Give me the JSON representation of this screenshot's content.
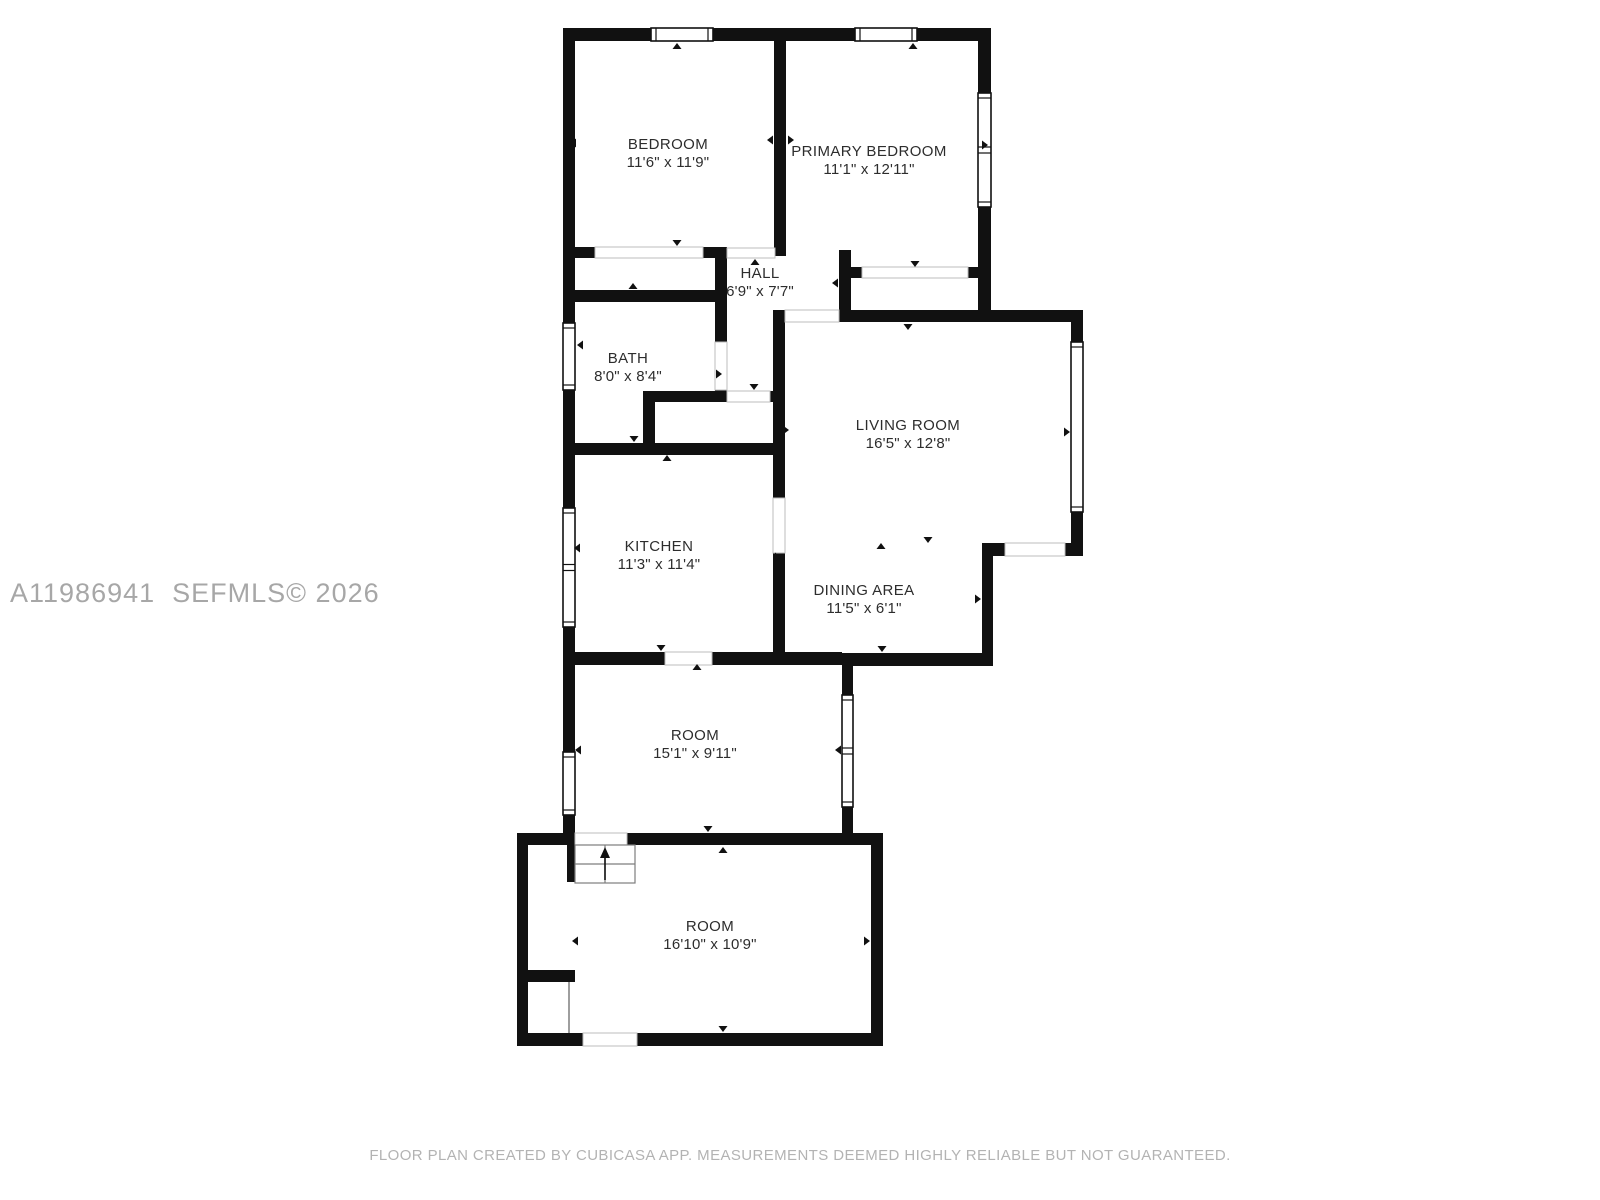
{
  "watermark": "A11986941  SEFMLS© 2026",
  "footer": "FLOOR PLAN CREATED BY CUBICASA APP. MEASUREMENTS DEEMED HIGHLY RELIABLE BUT NOT GUARANTEED.",
  "colors": {
    "wall": "#111111",
    "label": "#2d2d2d",
    "watermark": "#a7a7a7",
    "footer": "#b3b3b3",
    "door_line": "#bdbdbd",
    "stairs_line": "#7d7d7d",
    "floor": "#ffffff"
  },
  "rooms": [
    {
      "id": "bedroom",
      "name": "BEDROOM",
      "dims": "11'6\" x 11'9\"",
      "cx": 668,
      "cy": 144
    },
    {
      "id": "primary-bedroom",
      "name": "PRIMARY BEDROOM",
      "dims": "11'1\" x 12'11\"",
      "cx": 869,
      "cy": 151
    },
    {
      "id": "hall",
      "name": "HALL",
      "dims": "6'9\" x 7'7\"",
      "cx": 760,
      "cy": 273
    },
    {
      "id": "bath",
      "name": "BATH",
      "dims": "8'0\" x 8'4\"",
      "cx": 628,
      "cy": 358
    },
    {
      "id": "living-room",
      "name": "LIVING ROOM",
      "dims": "16'5\" x 12'8\"",
      "cx": 908,
      "cy": 425
    },
    {
      "id": "kitchen",
      "name": "KITCHEN",
      "dims": "11'3\" x 11'4\"",
      "cx": 659,
      "cy": 546
    },
    {
      "id": "dining-area",
      "name": "DINING AREA",
      "dims": "11'5\" x 6'1\"",
      "cx": 864,
      "cy": 590
    },
    {
      "id": "room-upper",
      "name": "ROOM",
      "dims": "15'1\" x 9'11\"",
      "cx": 695,
      "cy": 735
    },
    {
      "id": "room-lower",
      "name": "ROOM",
      "dims": "16'10\" x 10'9\"",
      "cx": 710,
      "cy": 926
    }
  ],
  "walls": [
    {
      "x": 563,
      "y": 28,
      "w": 428,
      "h": 13
    },
    {
      "x": 563,
      "y": 28,
      "w": 12,
      "h": 231
    },
    {
      "x": 774,
      "y": 28,
      "w": 12,
      "h": 228
    },
    {
      "x": 978,
      "y": 28,
      "w": 13,
      "h": 294
    },
    {
      "x": 563,
      "y": 247,
      "w": 164,
      "h": 11
    },
    {
      "x": 839,
      "y": 250,
      "w": 12,
      "h": 62
    },
    {
      "x": 839,
      "y": 267,
      "w": 144,
      "h": 11
    },
    {
      "x": 563,
      "y": 290,
      "w": 154,
      "h": 12
    },
    {
      "x": 563,
      "y": 259,
      "w": 12,
      "h": 404
    },
    {
      "x": 715,
      "y": 250,
      "w": 12,
      "h": 92
    },
    {
      "x": 715,
      "y": 390,
      "w": 12,
      "h": 12
    },
    {
      "x": 643,
      "y": 391,
      "w": 84,
      "h": 11
    },
    {
      "x": 770,
      "y": 391,
      "w": 15,
      "h": 11
    },
    {
      "x": 643,
      "y": 391,
      "w": 12,
      "h": 64
    },
    {
      "x": 563,
      "y": 443,
      "w": 222,
      "h": 12
    },
    {
      "x": 773,
      "y": 310,
      "w": 12,
      "h": 188
    },
    {
      "x": 773,
      "y": 553,
      "w": 12,
      "h": 110
    },
    {
      "x": 839,
      "y": 310,
      "w": 244,
      "h": 12
    },
    {
      "x": 1071,
      "y": 310,
      "w": 12,
      "h": 246
    },
    {
      "x": 982,
      "y": 543,
      "w": 101,
      "h": 13
    },
    {
      "x": 982,
      "y": 543,
      "w": 11,
      "h": 123
    },
    {
      "x": 842,
      "y": 653,
      "w": 151,
      "h": 13
    },
    {
      "x": 842,
      "y": 653,
      "w": 11,
      "h": 192
    },
    {
      "x": 563,
      "y": 652,
      "w": 279,
      "h": 13
    },
    {
      "x": 563,
      "y": 663,
      "w": 12,
      "h": 172
    },
    {
      "x": 517,
      "y": 833,
      "w": 366,
      "h": 12
    },
    {
      "x": 517,
      "y": 833,
      "w": 11,
      "h": 213
    },
    {
      "x": 517,
      "y": 1033,
      "w": 366,
      "h": 13
    },
    {
      "x": 871,
      "y": 833,
      "w": 12,
      "h": 213
    },
    {
      "x": 567,
      "y": 845,
      "w": 10,
      "h": 37
    },
    {
      "x": 528,
      "y": 970,
      "w": 47,
      "h": 12
    }
  ],
  "doors": [
    {
      "x": 595,
      "y": 247,
      "w": 108,
      "h": 11
    },
    {
      "x": 727,
      "y": 248,
      "w": 48,
      "h": 10
    },
    {
      "x": 862,
      "y": 267,
      "w": 106,
      "h": 11
    },
    {
      "x": 785,
      "y": 310,
      "w": 54,
      "h": 12
    },
    {
      "x": 715,
      "y": 342,
      "w": 12,
      "h": 48
    },
    {
      "x": 727,
      "y": 391,
      "w": 43,
      "h": 11
    },
    {
      "x": 773,
      "y": 498,
      "w": 12,
      "h": 55
    },
    {
      "x": 665,
      "y": 652,
      "w": 47,
      "h": 13
    },
    {
      "x": 1005,
      "y": 543,
      "w": 60,
      "h": 13
    },
    {
      "x": 583,
      "y": 1033,
      "w": 54,
      "h": 13
    },
    {
      "x": 575,
      "y": 833,
      "w": 52,
      "h": 12
    }
  ],
  "windows": [
    {
      "x": 651,
      "y": 28,
      "w": 62,
      "h": 13,
      "mid": false
    },
    {
      "x": 855,
      "y": 28,
      "w": 62,
      "h": 13,
      "mid": false
    },
    {
      "x": 978,
      "y": 93,
      "w": 13,
      "h": 114,
      "mid": true
    },
    {
      "x": 563,
      "y": 323,
      "w": 12,
      "h": 67,
      "mid": false
    },
    {
      "x": 563,
      "y": 508,
      "w": 12,
      "h": 119,
      "mid": true
    },
    {
      "x": 1071,
      "y": 342,
      "w": 12,
      "h": 170,
      "mid": false
    },
    {
      "x": 563,
      "y": 752,
      "w": 12,
      "h": 63,
      "mid": false
    },
    {
      "x": 842,
      "y": 695,
      "w": 11,
      "h": 112,
      "mid": true
    }
  ],
  "markers": [
    {
      "x": 677,
      "y": 46,
      "dir": "up"
    },
    {
      "x": 913,
      "y": 46,
      "dir": "up"
    },
    {
      "x": 573,
      "y": 143,
      "dir": "left"
    },
    {
      "x": 770,
      "y": 140,
      "dir": "left"
    },
    {
      "x": 791,
      "y": 140,
      "dir": "right"
    },
    {
      "x": 985,
      "y": 145,
      "dir": "right"
    },
    {
      "x": 677,
      "y": 243,
      "dir": "down"
    },
    {
      "x": 755,
      "y": 262,
      "dir": "up"
    },
    {
      "x": 915,
      "y": 264,
      "dir": "down"
    },
    {
      "x": 835,
      "y": 283,
      "dir": "left"
    },
    {
      "x": 633,
      "y": 286,
      "dir": "up"
    },
    {
      "x": 580,
      "y": 345,
      "dir": "left"
    },
    {
      "x": 719,
      "y": 374,
      "dir": "right"
    },
    {
      "x": 754,
      "y": 387,
      "dir": "down"
    },
    {
      "x": 908,
      "y": 327,
      "dir": "down"
    },
    {
      "x": 786,
      "y": 430,
      "dir": "right"
    },
    {
      "x": 1067,
      "y": 432,
      "dir": "right"
    },
    {
      "x": 634,
      "y": 439,
      "dir": "down"
    },
    {
      "x": 667,
      "y": 458,
      "dir": "up"
    },
    {
      "x": 577,
      "y": 548,
      "dir": "left"
    },
    {
      "x": 778,
      "y": 557,
      "dir": "right"
    },
    {
      "x": 881,
      "y": 546,
      "dir": "up"
    },
    {
      "x": 928,
      "y": 540,
      "dir": "down"
    },
    {
      "x": 978,
      "y": 599,
      "dir": "right"
    },
    {
      "x": 661,
      "y": 648,
      "dir": "down"
    },
    {
      "x": 697,
      "y": 667,
      "dir": "up"
    },
    {
      "x": 882,
      "y": 649,
      "dir": "down"
    },
    {
      "x": 578,
      "y": 750,
      "dir": "left"
    },
    {
      "x": 838,
      "y": 750,
      "dir": "left"
    },
    {
      "x": 708,
      "y": 829,
      "dir": "down"
    },
    {
      "x": 723,
      "y": 850,
      "dir": "up"
    },
    {
      "x": 575,
      "y": 941,
      "dir": "left"
    },
    {
      "x": 867,
      "y": 941,
      "dir": "right"
    },
    {
      "x": 723,
      "y": 1029,
      "dir": "down"
    }
  ],
  "stairs": {
    "x": 575,
    "y": 845,
    "w": 60,
    "h": 38
  },
  "partition": {
    "x1": 569,
    "y1": 982,
    "x2": 569,
    "y2": 1033
  }
}
